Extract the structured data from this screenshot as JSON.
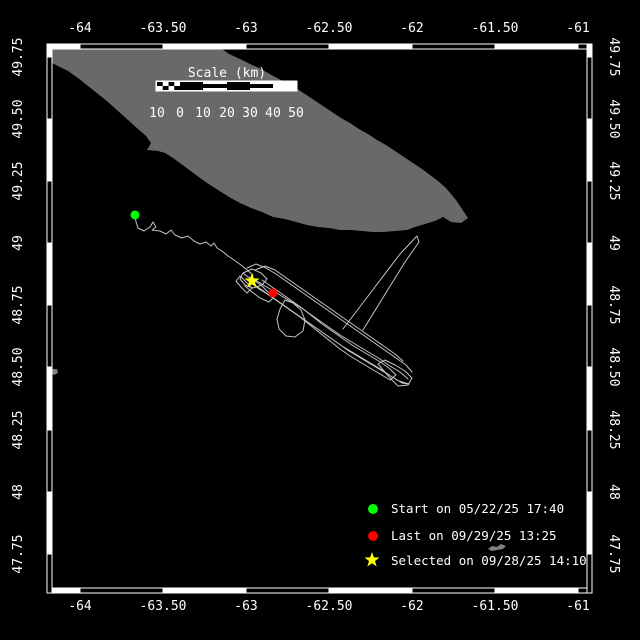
{
  "colors": {
    "background": "#000000",
    "frame": "#ffffff",
    "land": "#696969",
    "islet": "#808080",
    "track": "#c4c4c4",
    "text": "#ffffff",
    "start_marker": "#00ff00",
    "last_marker": "#ff0000",
    "selected_marker": "#ffff00"
  },
  "axes": {
    "lon_labels": [
      "-64",
      "-63.50",
      "-63",
      "-62.50",
      "-62",
      "-61.50",
      "-61"
    ],
    "lat_labels": [
      "49.75",
      "49.50",
      "49.25",
      "49",
      "48.75",
      "48.50",
      "48.25",
      "48",
      "47.75"
    ]
  },
  "scalebar": {
    "title": "Scale (km)",
    "labels": [
      "10",
      "0",
      "10",
      "20",
      "30",
      "40",
      "50"
    ]
  },
  "legend": {
    "start": {
      "marker": "green-circle",
      "label": "Start on 05/22/25 17:40"
    },
    "last": {
      "marker": "red-circle",
      "label": "Last on 09/29/25 13:25"
    },
    "selected": {
      "marker": "yellow-star",
      "label": "Selected on 09/28/25 14:10"
    }
  },
  "map": {
    "island_points": "48,49 222,49 229,54 240,59 250,64 259,68 268,73 277,78 287,83 296,88 305,94 314,100 323,106 332,112 341,118 350,123 359,129 368,134 377,140 386,145 395,151 404,157 413,163 422,169 430,175 438,181 446,188 451,194 456,200 460,206 464,212 468,218 461,223 451,222 443,217 435,221 425,224 415,227 407,230 395,231 383,232 373,232 362,231 351,230 340,230 329,228 318,227 307,225 296,222 285,219 273,217 262,212 251,208 240,203 229,197 218,190 207,183 196,175 184,166 173,158 165,153 158,151 147,150 151,143 146,136 138,129 128,120 118,111 108,102 98,94 88,86 78,78 68,71 58,66 50,62 48,61",
    "islet1_points": "488,549 492,546 497,547 501,544 506,546 503,549 497,550 492,551",
    "islet2_points": "52,369 57,369 58,373 54,375 51,373",
    "track": {
      "p0": "135,215 136,222 138,228 144,231 150,227 153,222 156,227 152,230 160,231 166,234 171,230 175,235 182,238 188,236 194,241 200,244 206,242 211,246 214,243 217,248 222,251 228,256 234,260 241,265 247,270 253,275",
      "p1": "247,268 256,264 266,268 276,274 286,281 296,288 306,295 316,302 326,309 336,316 346,323 356,330 366,337 376,344 386,351 396,358 406,365 412,372",
      "p2": "250,277 260,283 270,289 280,295 290,301 300,307 310,314 320,321 330,328 340,335 350,341 360,347 370,353 380,359 390,366 400,372 408,379",
      "p3": "252,283 262,290 272,297 282,304 292,311 302,318 312,325 322,332 332,339 342,346 352,352 362,358 372,364 382,370 392,377 402,383 409,384 399,381 389,375 379,369 369,363 359,357 349,351 339,344 329,337 319,330 309,323 299,316 289,309 279,302 269,295 259,289 251,283",
      "p4": "243,273 252,269 261,273 267,279 262,285 253,288 245,285 240,279 243,273 248,277 255,281 262,286 268,292 274,297 269,302 260,298 252,292 245,286",
      "p5": "285,300 280,309 277,319 279,329 286,336 295,337 303,331 305,320 301,310 293,303 285,300",
      "p6": "385,360 395,365 405,371 412,378 408,385 398,386 391,379 384,371 378,364 385,360",
      "p7": "262,280 272,287 282,294 292,301 302,308 312,316 322,324 332,331 342,338 352,345 362,351 372,357 382,363 390,369 396,375 390,380 380,374 370,368 360,362 350,356 340,349 330,341 320,333 310,325 300,317 290,310 280,303 270,296 262,290",
      "p8": "343,329 400,254 417,236 419,242 405,262 363,330",
      "p9": "255,270 265,266 275,270 285,277 295,284 305,291 315,298 325,305 335,312 345,319 355,326 365,333 375,340 385,347 395,354 403,361",
      "p10": "240,276 246,282 252,288 247,293 241,287 236,281 240,276"
    },
    "markers": {
      "star_points": "0,-8 1.9,-2.6 7.6,-2.5 3,1 4.7,6.5 0,3.2 -4.7,6.5 -3,1 -7.6,-2.5 -1.9,-2.6",
      "start": {
        "transform": "translate(135,215)"
      },
      "last": {
        "transform": "translate(273,293)"
      },
      "selected": {
        "transform": "translate(252,281)"
      }
    }
  }
}
